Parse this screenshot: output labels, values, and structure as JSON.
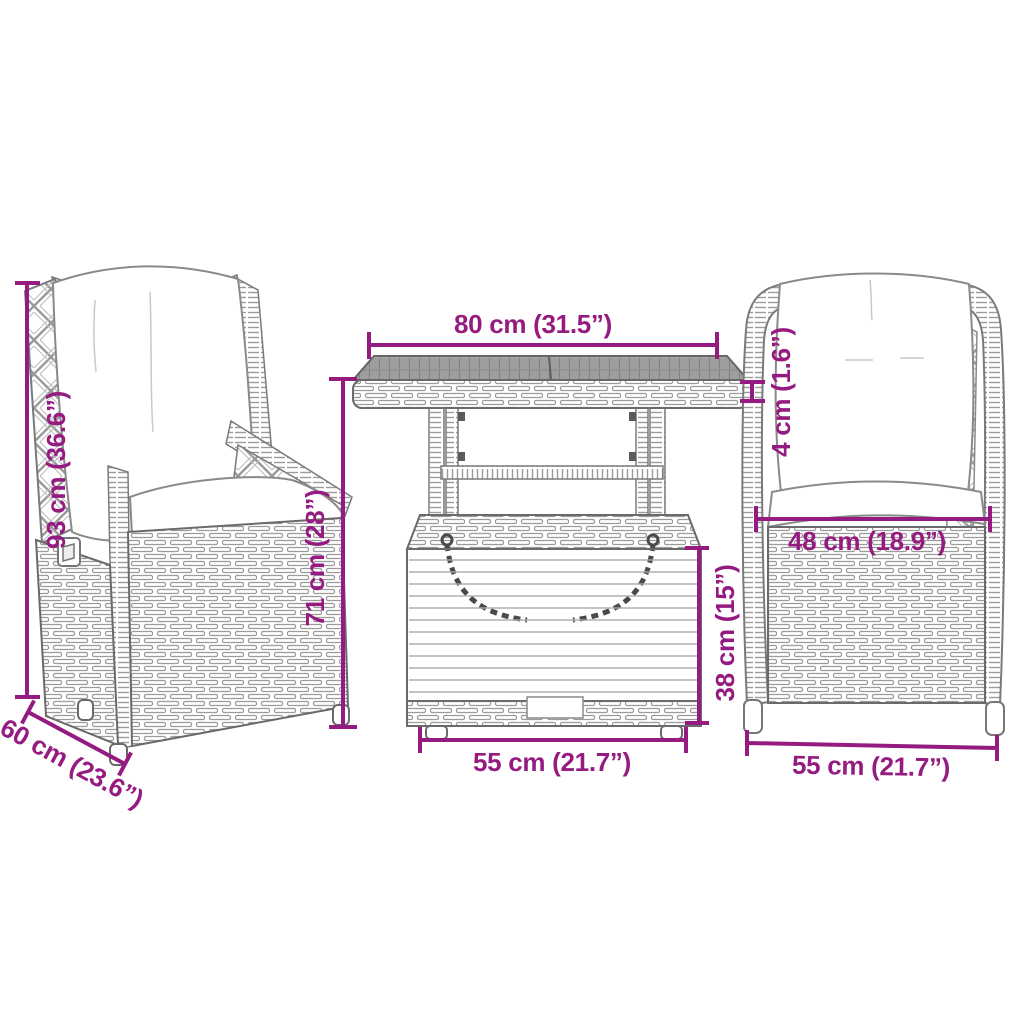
{
  "diagram_type": "furniture-dimension-diagram",
  "dimension_color": "#951B81",
  "dimensions": {
    "table": {
      "top_width": "80 cm (31.5”)",
      "top_thickness": "4 cm (1.6”)",
      "base_height": "38 cm (15”)",
      "base_width": "55 cm (21.7”)"
    },
    "chair": {
      "height": "93 cm (36.6”)",
      "back_height": "71 cm (28”)",
      "depth": "60 cm (23.6”)",
      "seat_width": "48 cm (18.9”)",
      "width": "55 cm (21.7”)"
    }
  }
}
